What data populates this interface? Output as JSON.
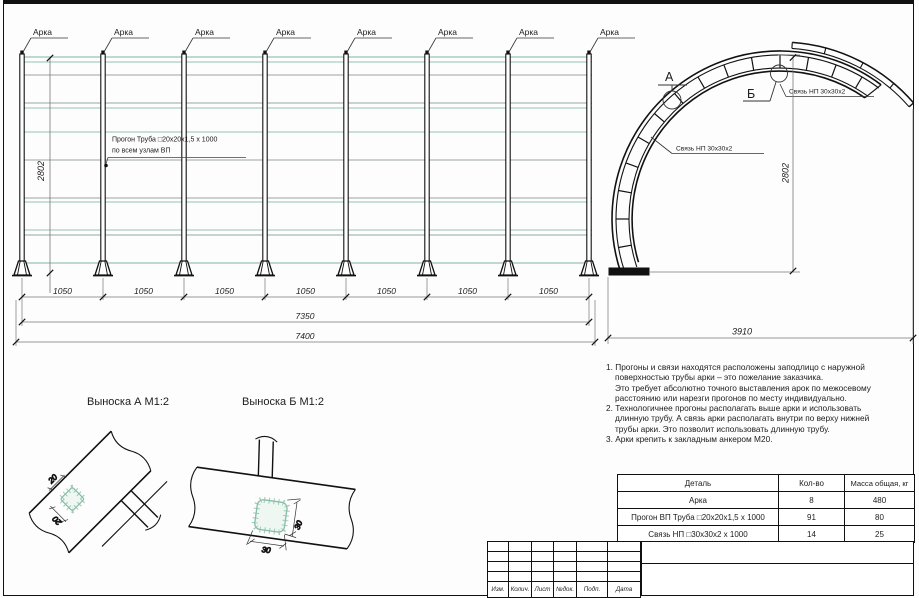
{
  "drawing": {
    "elevation": {
      "arch_labels": [
        "Арка",
        "Арка",
        "Арка",
        "Арка",
        "Арка",
        "Арка",
        "Арка",
        "Арка"
      ],
      "purlin_note": {
        "line1": "Прогон Труба □20x20x1,5 х 1000",
        "line2": "по всем узлам ВП"
      },
      "height_dim": "2802",
      "spacing_dims": [
        "1050",
        "1050",
        "1050",
        "1050",
        "1050",
        "1050",
        "1050"
      ],
      "subtotal_dim": "7350",
      "total_dim": "7400"
    },
    "section": {
      "callout_a": "А",
      "callout_b": "Б",
      "tie_label_top": "Связь НП 30х30х2",
      "tie_label_side": "Связь НП 30х30х2",
      "height_dim": "2802",
      "width_dim": "3910"
    },
    "detail_a": {
      "title": "Выноска А М1:2",
      "dim1": "20",
      "dim2": "20"
    },
    "detail_b": {
      "title": "Выноска Б М1:2",
      "dim1": "30",
      "dim2": "30"
    }
  },
  "notes": {
    "lines": [
      "1. Прогоны и связи находятся расположены заподлицо с наружной",
      "поверхностью трубы арки – это пожелание заказчика.",
      "Это требует абсолютно точного выставления арок по межосевому",
      "расстоянию или нарезги прогонов по месту индивидуально.",
      "2. Технологичнее прогоны располагать выше арки и использовать",
      "длинную трубу. А связь арки располагать внутри по верху нижней",
      "трубы арки. Это позволит использовать длинную трубу.",
      "3. Арки крепить к закладным анкером М20."
    ]
  },
  "parts_table": {
    "headers": [
      "Деталь",
      "Кол-во",
      "Масса общая, кг"
    ],
    "rows": [
      {
        "detail": "Арка",
        "qty": "8",
        "mass": "480"
      },
      {
        "detail": "Прогон ВП Труба □20x20x1,5 х 1000",
        "qty": "91",
        "mass": "80"
      },
      {
        "detail": "Связь НП □30х30х2 х 1000",
        "qty": "14",
        "mass": "25"
      }
    ]
  },
  "title_block": {
    "labels": [
      "Изм.",
      "Колич.",
      "Лист",
      "№док.",
      "Подп.",
      "Дата"
    ]
  },
  "colors": {
    "line": "#1c1c1c",
    "purlin_green": "#a9cfc0",
    "purlin_gray": "#9aa3a3",
    "tube_fill": "#eef7f1",
    "tube_stroke": "#85bda5",
    "dim_line": "#777777"
  }
}
